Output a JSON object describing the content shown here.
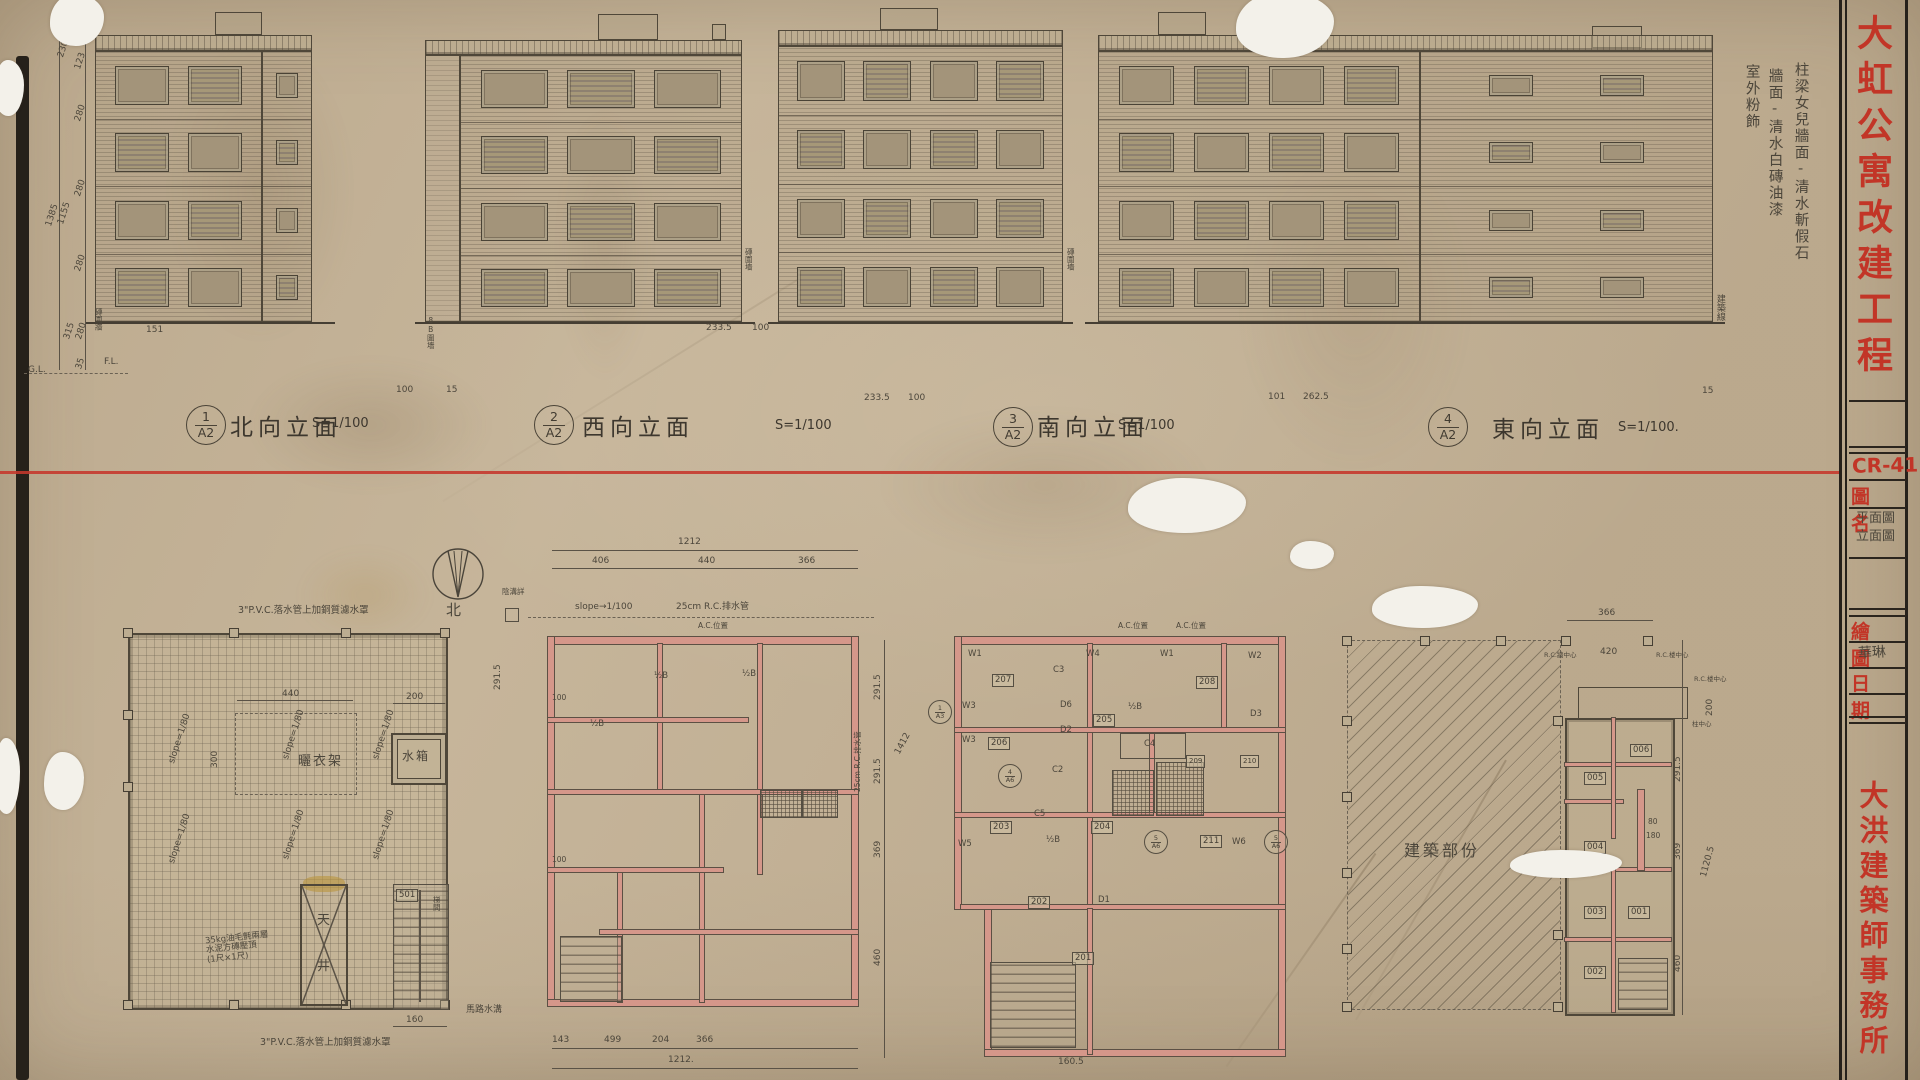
{
  "title_block": {
    "project_title": "大虹公寓改建工程",
    "firm_name": "大洪建築師事務所",
    "drawing_no": "CR-411",
    "drawing_name_label": "圖名",
    "drawing_name_line1": "平面圖",
    "drawing_name_line2": "立面圖",
    "drawn_by_label": "繪圖",
    "drawn_by_value": "華琳",
    "date_label": "日期"
  },
  "finish_notes": {
    "col1": "柱梁女兒牆面-清水斬假石",
    "col2": "牆面-清水白磚油漆",
    "col3": "室外粉飾"
  },
  "site_labels": {
    "building_line": "建築線",
    "fence1": "8B圍墻",
    "fence2": "磚圍墻",
    "fence3": "磚圍墻",
    "brick_fence_left": "磚圍牆",
    "gl": "G.L.",
    "fl": "F.L."
  },
  "elevations": [
    {
      "num": "1",
      "sheet": "A2",
      "title": "北向立面",
      "scale": "S=1/100",
      "floors": 4,
      "bays": 2
    },
    {
      "num": "2",
      "sheet": "A2",
      "title": "西向立面",
      "scale": "S=1/100",
      "floors": 4,
      "bays": 3
    },
    {
      "num": "3",
      "sheet": "A2",
      "title": "南向立面",
      "scale": "S=1/100",
      "floors": 4,
      "bays": 4
    },
    {
      "num": "4",
      "sheet": "A2",
      "title": "東向立面",
      "scale": "S=1/100.",
      "floors": 4,
      "bays": 4
    }
  ],
  "elev_dims": {
    "stack": [
      "107",
      "123",
      "230",
      "280",
      "280",
      "280",
      "1385",
      "1155",
      "315",
      "280",
      "35"
    ],
    "d151": "151",
    "d100a": "100",
    "d15a": "15",
    "d233a": "233.5",
    "d100b": "100",
    "d233b": "233.5",
    "d100c": "100",
    "d101": "101",
    "d262": "262.5",
    "d15b": "15"
  },
  "compass": {
    "north": "北"
  },
  "roof_plan": {
    "note_top": "3\"P.V.C.落水管上加銅質濾水罩",
    "note_bottom": "3\"P.V.C.落水管上加銅質濾水罩",
    "drying_rack": "曬衣架",
    "water_tank": "水箱",
    "light_well_1": "天",
    "light_well_2": "井",
    "stair_no": "501",
    "stair_label": "梯間",
    "parapet_note1": "35kg油毛氈兩層",
    "parapet_note2": "水泥方磚壓頂",
    "parapet_note3": "(1尺×1尺)",
    "slope": "slope=1/80",
    "dim_440": "440",
    "dim_300": "300",
    "dim_200": "200",
    "dim_160": "160"
  },
  "plan2": {
    "dim_total_top": "1212",
    "dims_top": [
      "406",
      "440",
      "366"
    ],
    "dims_bottom": [
      "143",
      "499",
      "204",
      "366"
    ],
    "dim_total_bottom": "1212.",
    "dim_291": "291.5",
    "dim_100a": "100",
    "dim_100b": "100",
    "eave_note": "slope→1/100",
    "drain_note": "25cm R.C.排水管",
    "gutter_detail": "陰溝詳",
    "road_gutter": "馬路水溝",
    "ac_note": "A.C.位置",
    "wall_b1": "½B",
    "wall_b2": "½B",
    "wall_b3": "½B"
  },
  "plan3": {
    "ac_note1": "A.C.位置",
    "ac_note2": "A.C.位置",
    "rooms": {
      "r201": "201",
      "r202": "202",
      "r203": "203",
      "r204": "204",
      "r205": "205",
      "r206": "206",
      "r207": "207",
      "r208": "208",
      "r209": "209",
      "r210": "210",
      "r211": "211"
    },
    "w1": "W1",
    "w1b": "W1",
    "w2": "W2",
    "w3": "W3",
    "w3b": "W3",
    "w4": "W4",
    "w5": "W5",
    "w6": "W6",
    "d1": "D1",
    "d2": "D2",
    "d3": "D3",
    "d6": "D6",
    "c2": "C2",
    "c3": "C3",
    "c4": "C4",
    "c5": "C5",
    "wall_b1": "½B",
    "wall_b2": "½B",
    "sec1_no": "1",
    "sec1_sheet": "A3",
    "sec2_no": "4",
    "sec2_sheet": "A6",
    "sec3_no": "5",
    "sec3_sheet": "A6",
    "sec4_no": "5",
    "sec4_sheet": "A6",
    "dim_291a": "291.5",
    "dim_291b": "291.5",
    "dim_369": "369",
    "dim_460": "460",
    "dim_1412": "1412",
    "drain_note": "25cm R.C.排水管",
    "dim_160": "160.5"
  },
  "demolition": {
    "label": "建築部份"
  },
  "plan5": {
    "dim_366": "366",
    "dim_420": "420",
    "dim_200": "200",
    "dim_291": "291.5",
    "dim_369": "369",
    "dim_460": "460",
    "dim_total": "1120.5",
    "dim_80": "80",
    "dim_180": "180",
    "rc_wall": "R.C.牆中心",
    "rc_slab1": "R.C.楼中心",
    "rc_slab2": "R.C.楼中心",
    "col_center": "柱中心",
    "rooms": {
      "r001": "001",
      "r002": "002",
      "r003": "003",
      "r004": "004",
      "r005": "005",
      "r006": "006"
    }
  }
}
